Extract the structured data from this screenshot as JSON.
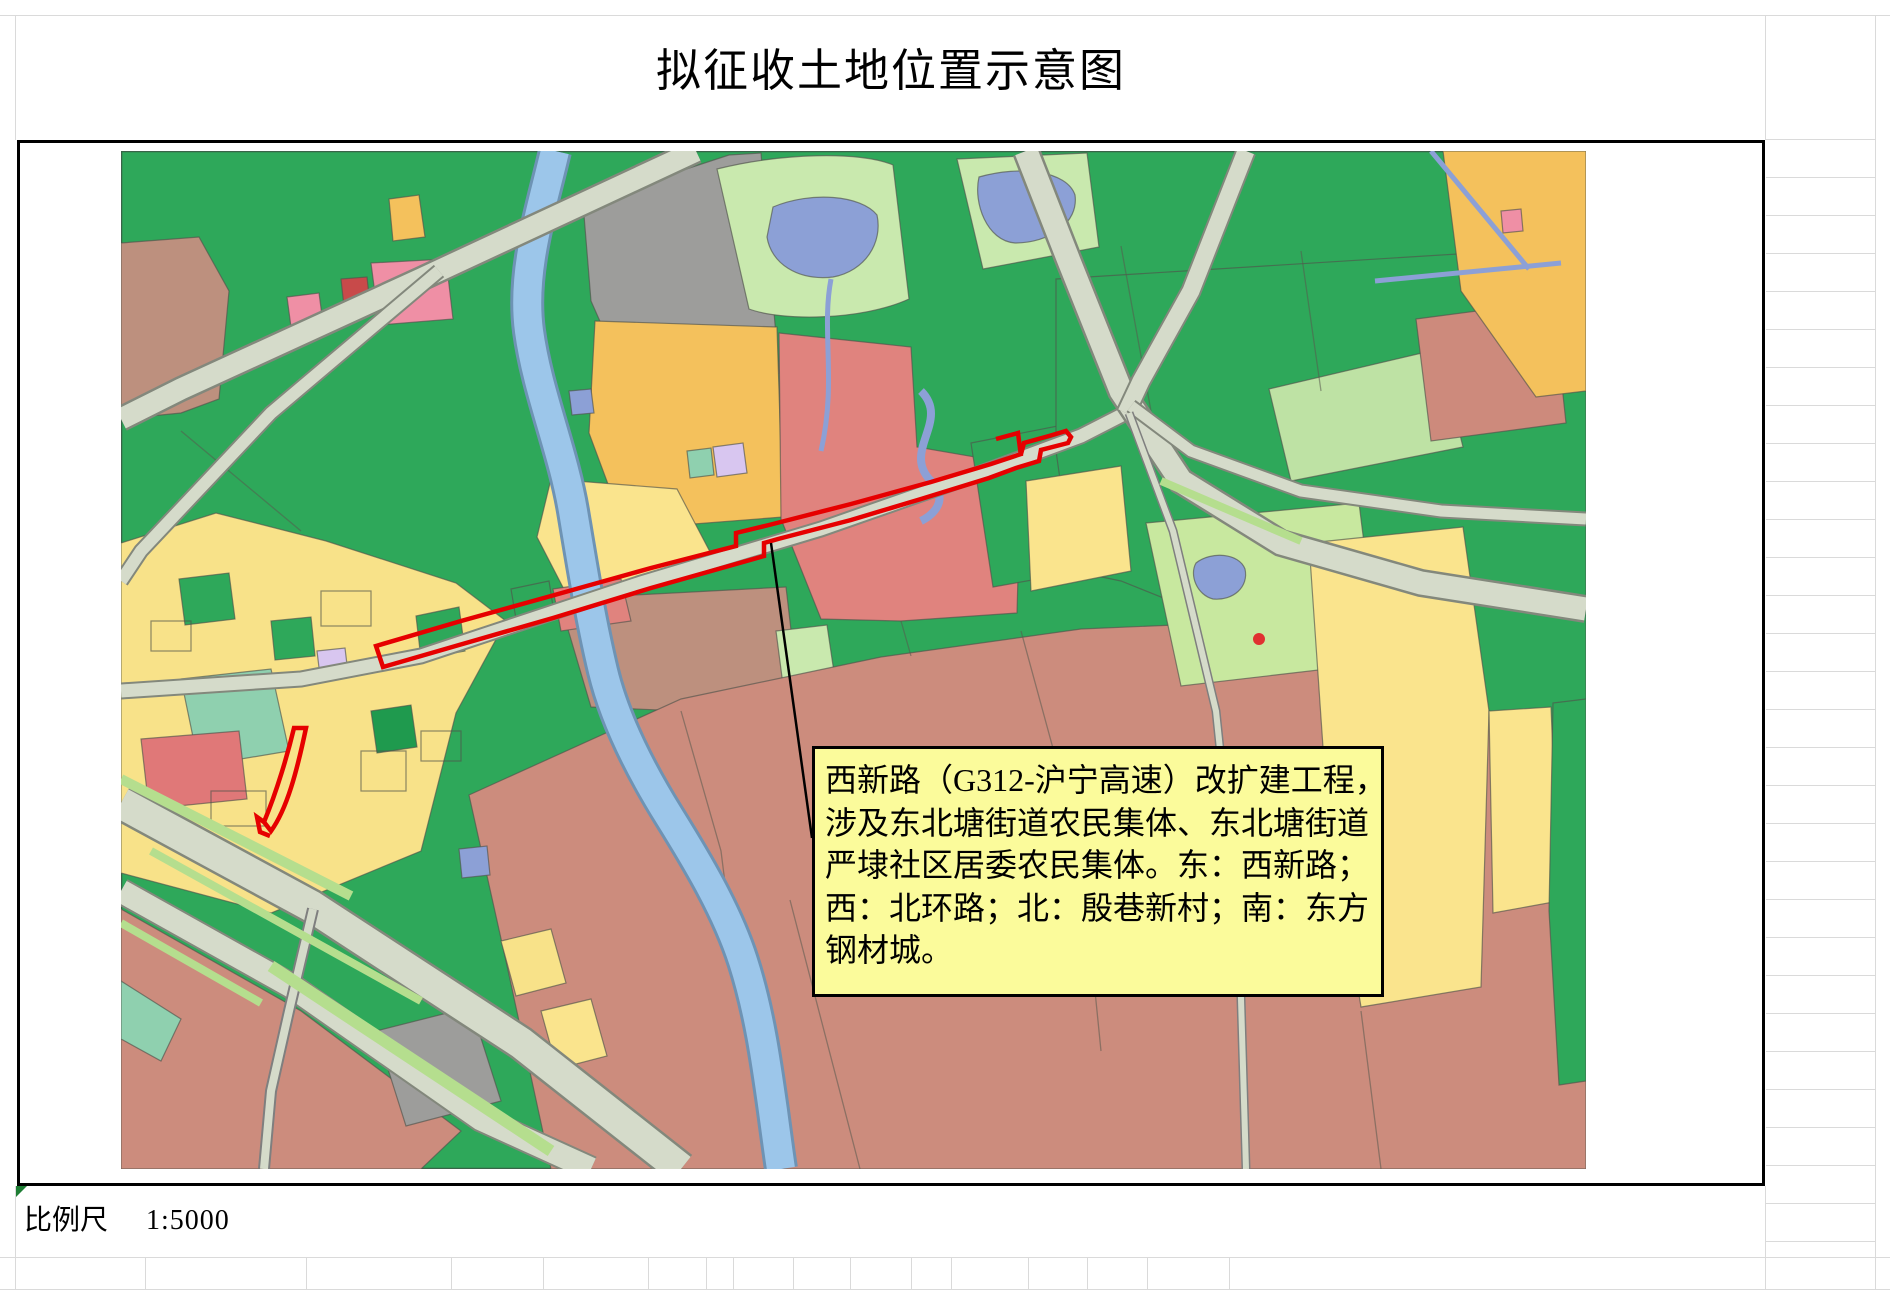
{
  "title": "拟征收土地位置示意图",
  "scale": {
    "label": "比例尺",
    "value": "1:5000"
  },
  "annotation": {
    "lines": [
      "西新路（G312-沪宁高速）改扩建工程，",
      "涉及东北塘街道农民集体、东北塘街道",
      "严埭社区居委农民集体。东：西新路；",
      "西：北环路；北：殷巷新村；南：东方",
      "钢材城。"
    ],
    "background_color": "#FBFB9B",
    "border_color": "#000000"
  },
  "map": {
    "boundary_color": "#E60000",
    "leader_color": "#000000",
    "colors": {
      "farmland_green": "#2EA85A",
      "village_yellow": "#F8E289",
      "pale_yellow": "#FAE48D",
      "orchard_orange": "#F4C15C",
      "construction_salmon": "#E0837E",
      "urban_rose": "#CC8C7D",
      "brown_parcel": "#BD907E",
      "gray_parcel": "#9D9D9B",
      "pink_parcel": "#EF8FA5",
      "road_fill": "#D5DBCA",
      "river_blue": "#9CC6EA",
      "pond_blue": "#8CA0D6",
      "greenway": "#B5DE8E",
      "light_green_parcel": "#C8E89F"
    }
  },
  "grid": {
    "line_color": "#DADADA"
  }
}
